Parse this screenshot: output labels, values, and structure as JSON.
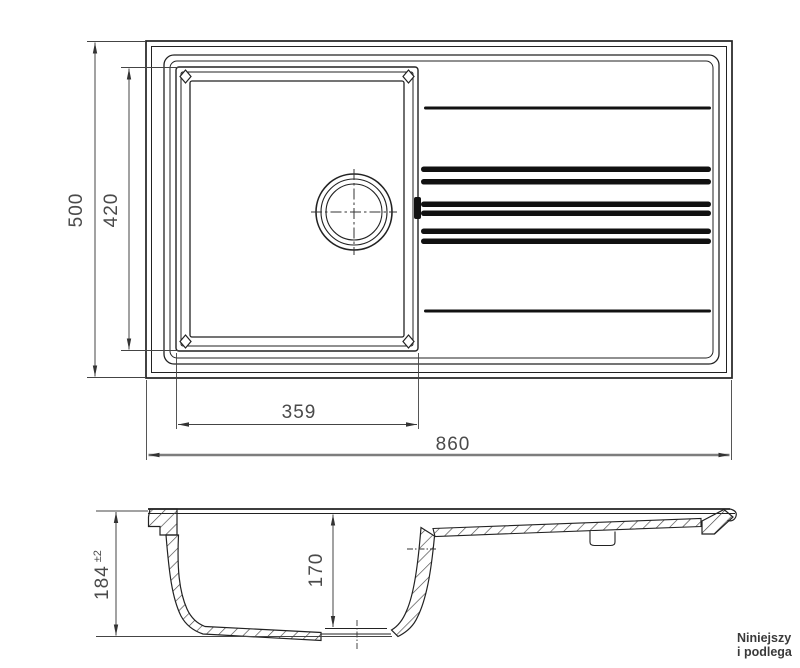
{
  "colors": {
    "line": "#222222",
    "dim_line": "#444444",
    "dim_text": "#4a4a4a",
    "groove": "#111111",
    "note_text": "#3a3a3a"
  },
  "top_view": {
    "overall_width_mm": "860",
    "overall_depth_mm": "500",
    "bowl_length_mm": "420",
    "bowl_width_mm": "359"
  },
  "section_view": {
    "overall_height_mm": "184",
    "overall_height_tolerance": "±2",
    "bowl_depth_mm": "170"
  },
  "note": {
    "line1": "Niniejszy",
    "line2": "i podlega"
  }
}
